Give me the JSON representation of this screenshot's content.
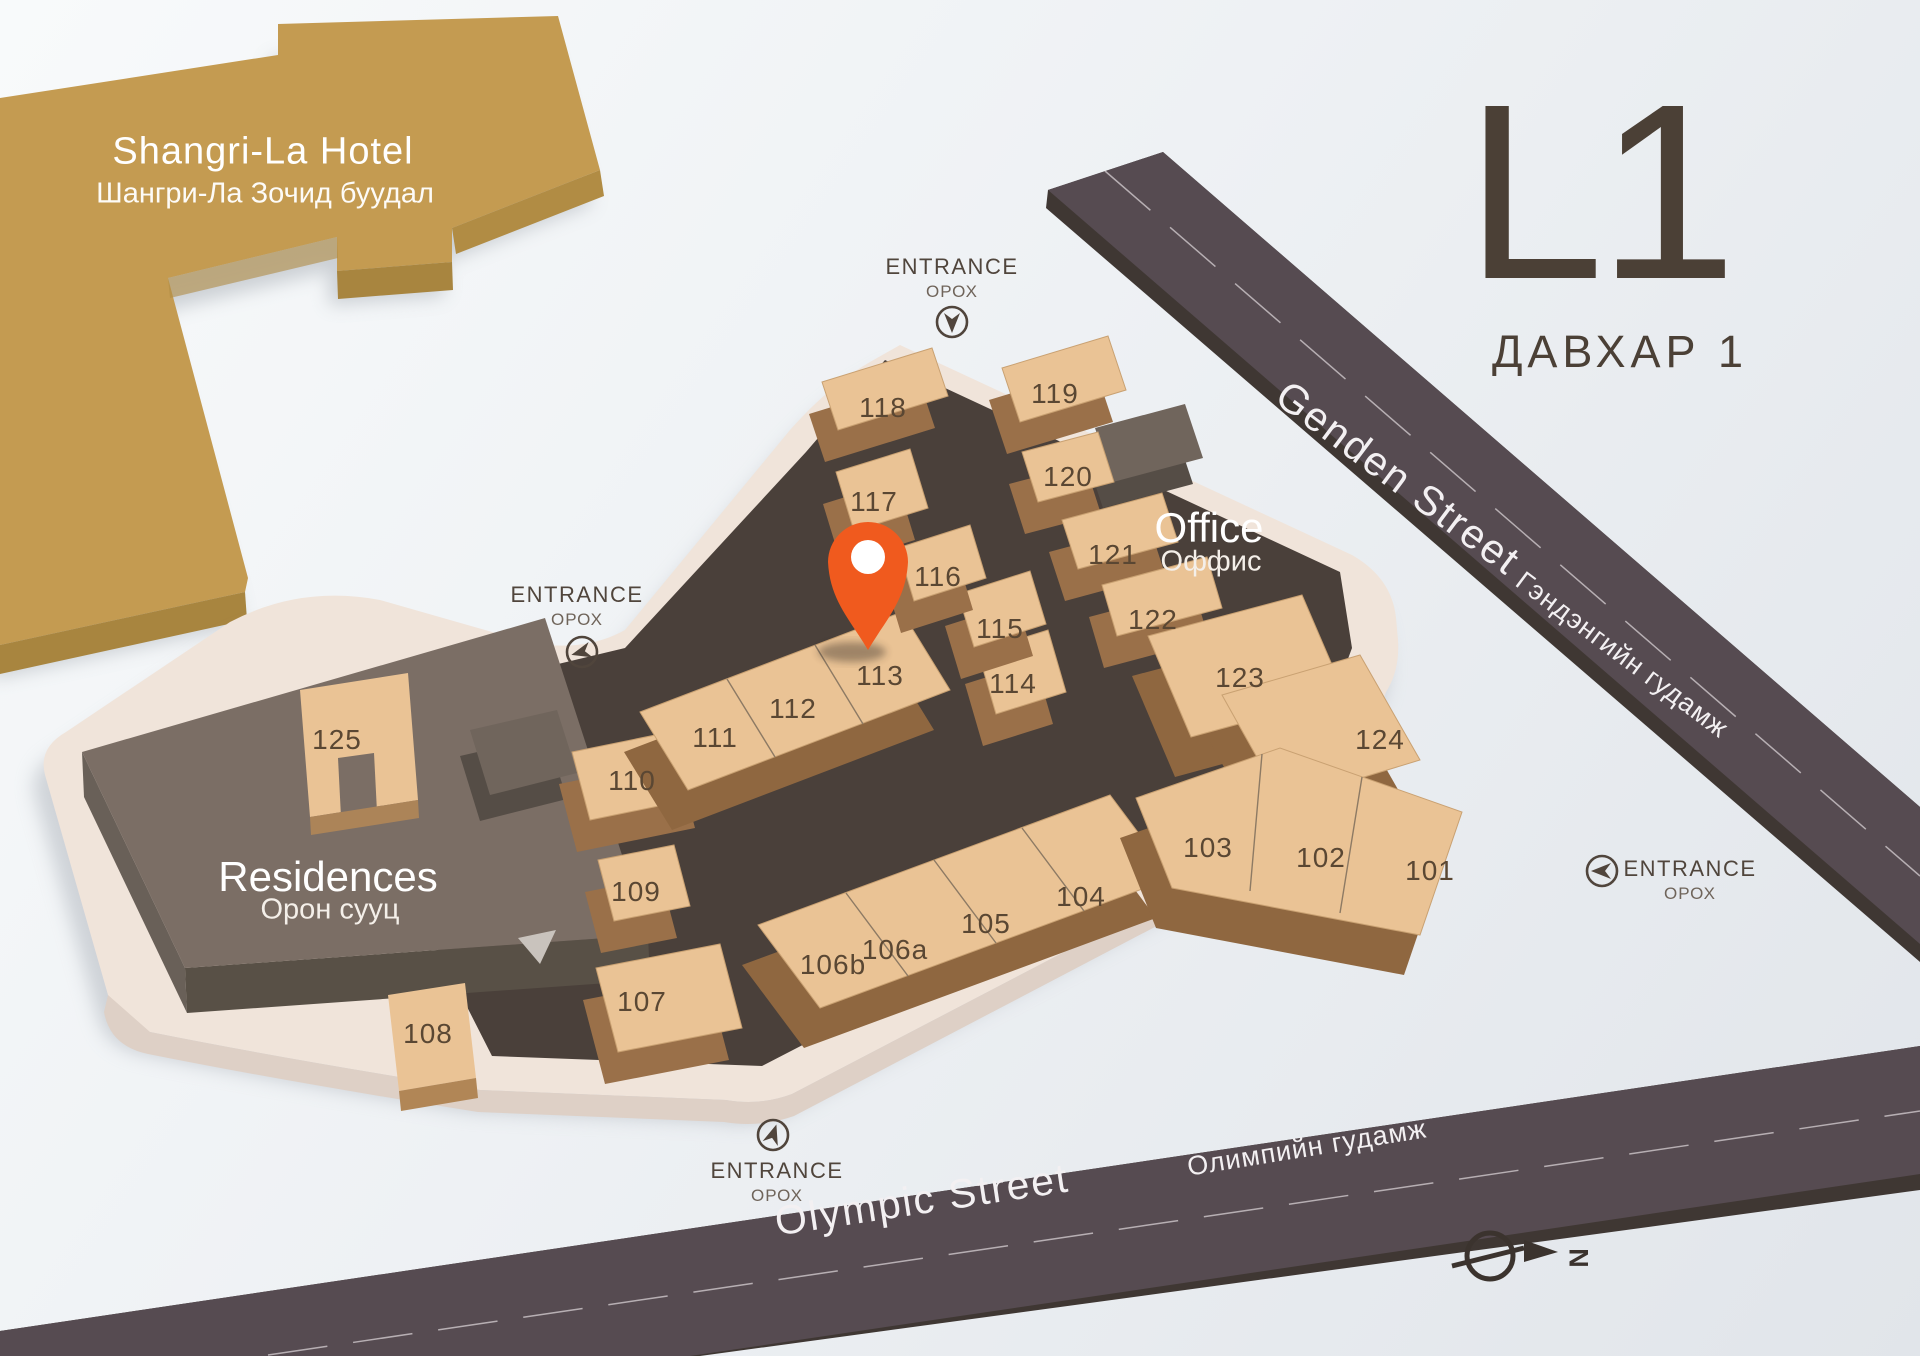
{
  "floor": {
    "code": "L1",
    "name_mn": "ДАВХАР 1"
  },
  "hotel": {
    "name": "Shangri-La Hotel",
    "name_mn": "Шангри-Ла Зочид буудал"
  },
  "zones": {
    "office": {
      "name": "Office",
      "name_mn": "Оффис"
    },
    "residences": {
      "name": "Residences",
      "name_mn": "Орон сууц"
    }
  },
  "streets": {
    "genden": {
      "name": "Genden Street",
      "name_mn": "Гэндэнгийн гудамж"
    },
    "olympic": {
      "name": "Olympic Street",
      "name_mn": "Олимпийн гудамж"
    }
  },
  "entrances": [
    {
      "id": "north",
      "label": "ENTRANCE",
      "label_mn": "ОРОХ"
    },
    {
      "id": "west",
      "label": "ENTRANCE",
      "label_mn": "ОРОХ"
    },
    {
      "id": "east",
      "label": "ENTRANCE",
      "label_mn": "ОРОХ"
    },
    {
      "id": "south",
      "label": "ENTRANCE",
      "label_mn": "ОРОХ"
    }
  ],
  "units": [
    {
      "id": "101",
      "x": 1430,
      "y": 871
    },
    {
      "id": "102",
      "x": 1321,
      "y": 858
    },
    {
      "id": "103",
      "x": 1208,
      "y": 848
    },
    {
      "id": "104",
      "x": 1081,
      "y": 897
    },
    {
      "id": "105",
      "x": 986,
      "y": 924
    },
    {
      "id": "106a",
      "x": 895,
      "y": 950
    },
    {
      "id": "106b",
      "x": 833,
      "y": 965
    },
    {
      "id": "107",
      "x": 642,
      "y": 1002
    },
    {
      "id": "108",
      "x": 428,
      "y": 1034
    },
    {
      "id": "109",
      "x": 636,
      "y": 892
    },
    {
      "id": "110",
      "x": 632,
      "y": 781
    },
    {
      "id": "111",
      "x": 715,
      "y": 738
    },
    {
      "id": "112",
      "x": 793,
      "y": 709
    },
    {
      "id": "113",
      "x": 880,
      "y": 676
    },
    {
      "id": "114",
      "x": 1013,
      "y": 684
    },
    {
      "id": "115",
      "x": 1000,
      "y": 629
    },
    {
      "id": "116",
      "x": 938,
      "y": 577
    },
    {
      "id": "117",
      "x": 874,
      "y": 502
    },
    {
      "id": "118",
      "x": 883,
      "y": 408
    },
    {
      "id": "119",
      "x": 1055,
      "y": 394
    },
    {
      "id": "120",
      "x": 1068,
      "y": 477
    },
    {
      "id": "121",
      "x": 1113,
      "y": 555
    },
    {
      "id": "122",
      "x": 1153,
      "y": 620
    },
    {
      "id": "123",
      "x": 1240,
      "y": 678
    },
    {
      "id": "124",
      "x": 1380,
      "y": 740
    },
    {
      "id": "125",
      "x": 337,
      "y": 740
    }
  ],
  "marker": {
    "near_unit": "113"
  },
  "compass": {
    "label": "N"
  },
  "colors": {
    "pin": "#f05a1e",
    "hotel": "#c49b51",
    "unit_top": "#eac395",
    "walkway": "#4a403a",
    "street": "#564b51",
    "plate": "#f0e4da",
    "residences": "#7b6e65"
  }
}
